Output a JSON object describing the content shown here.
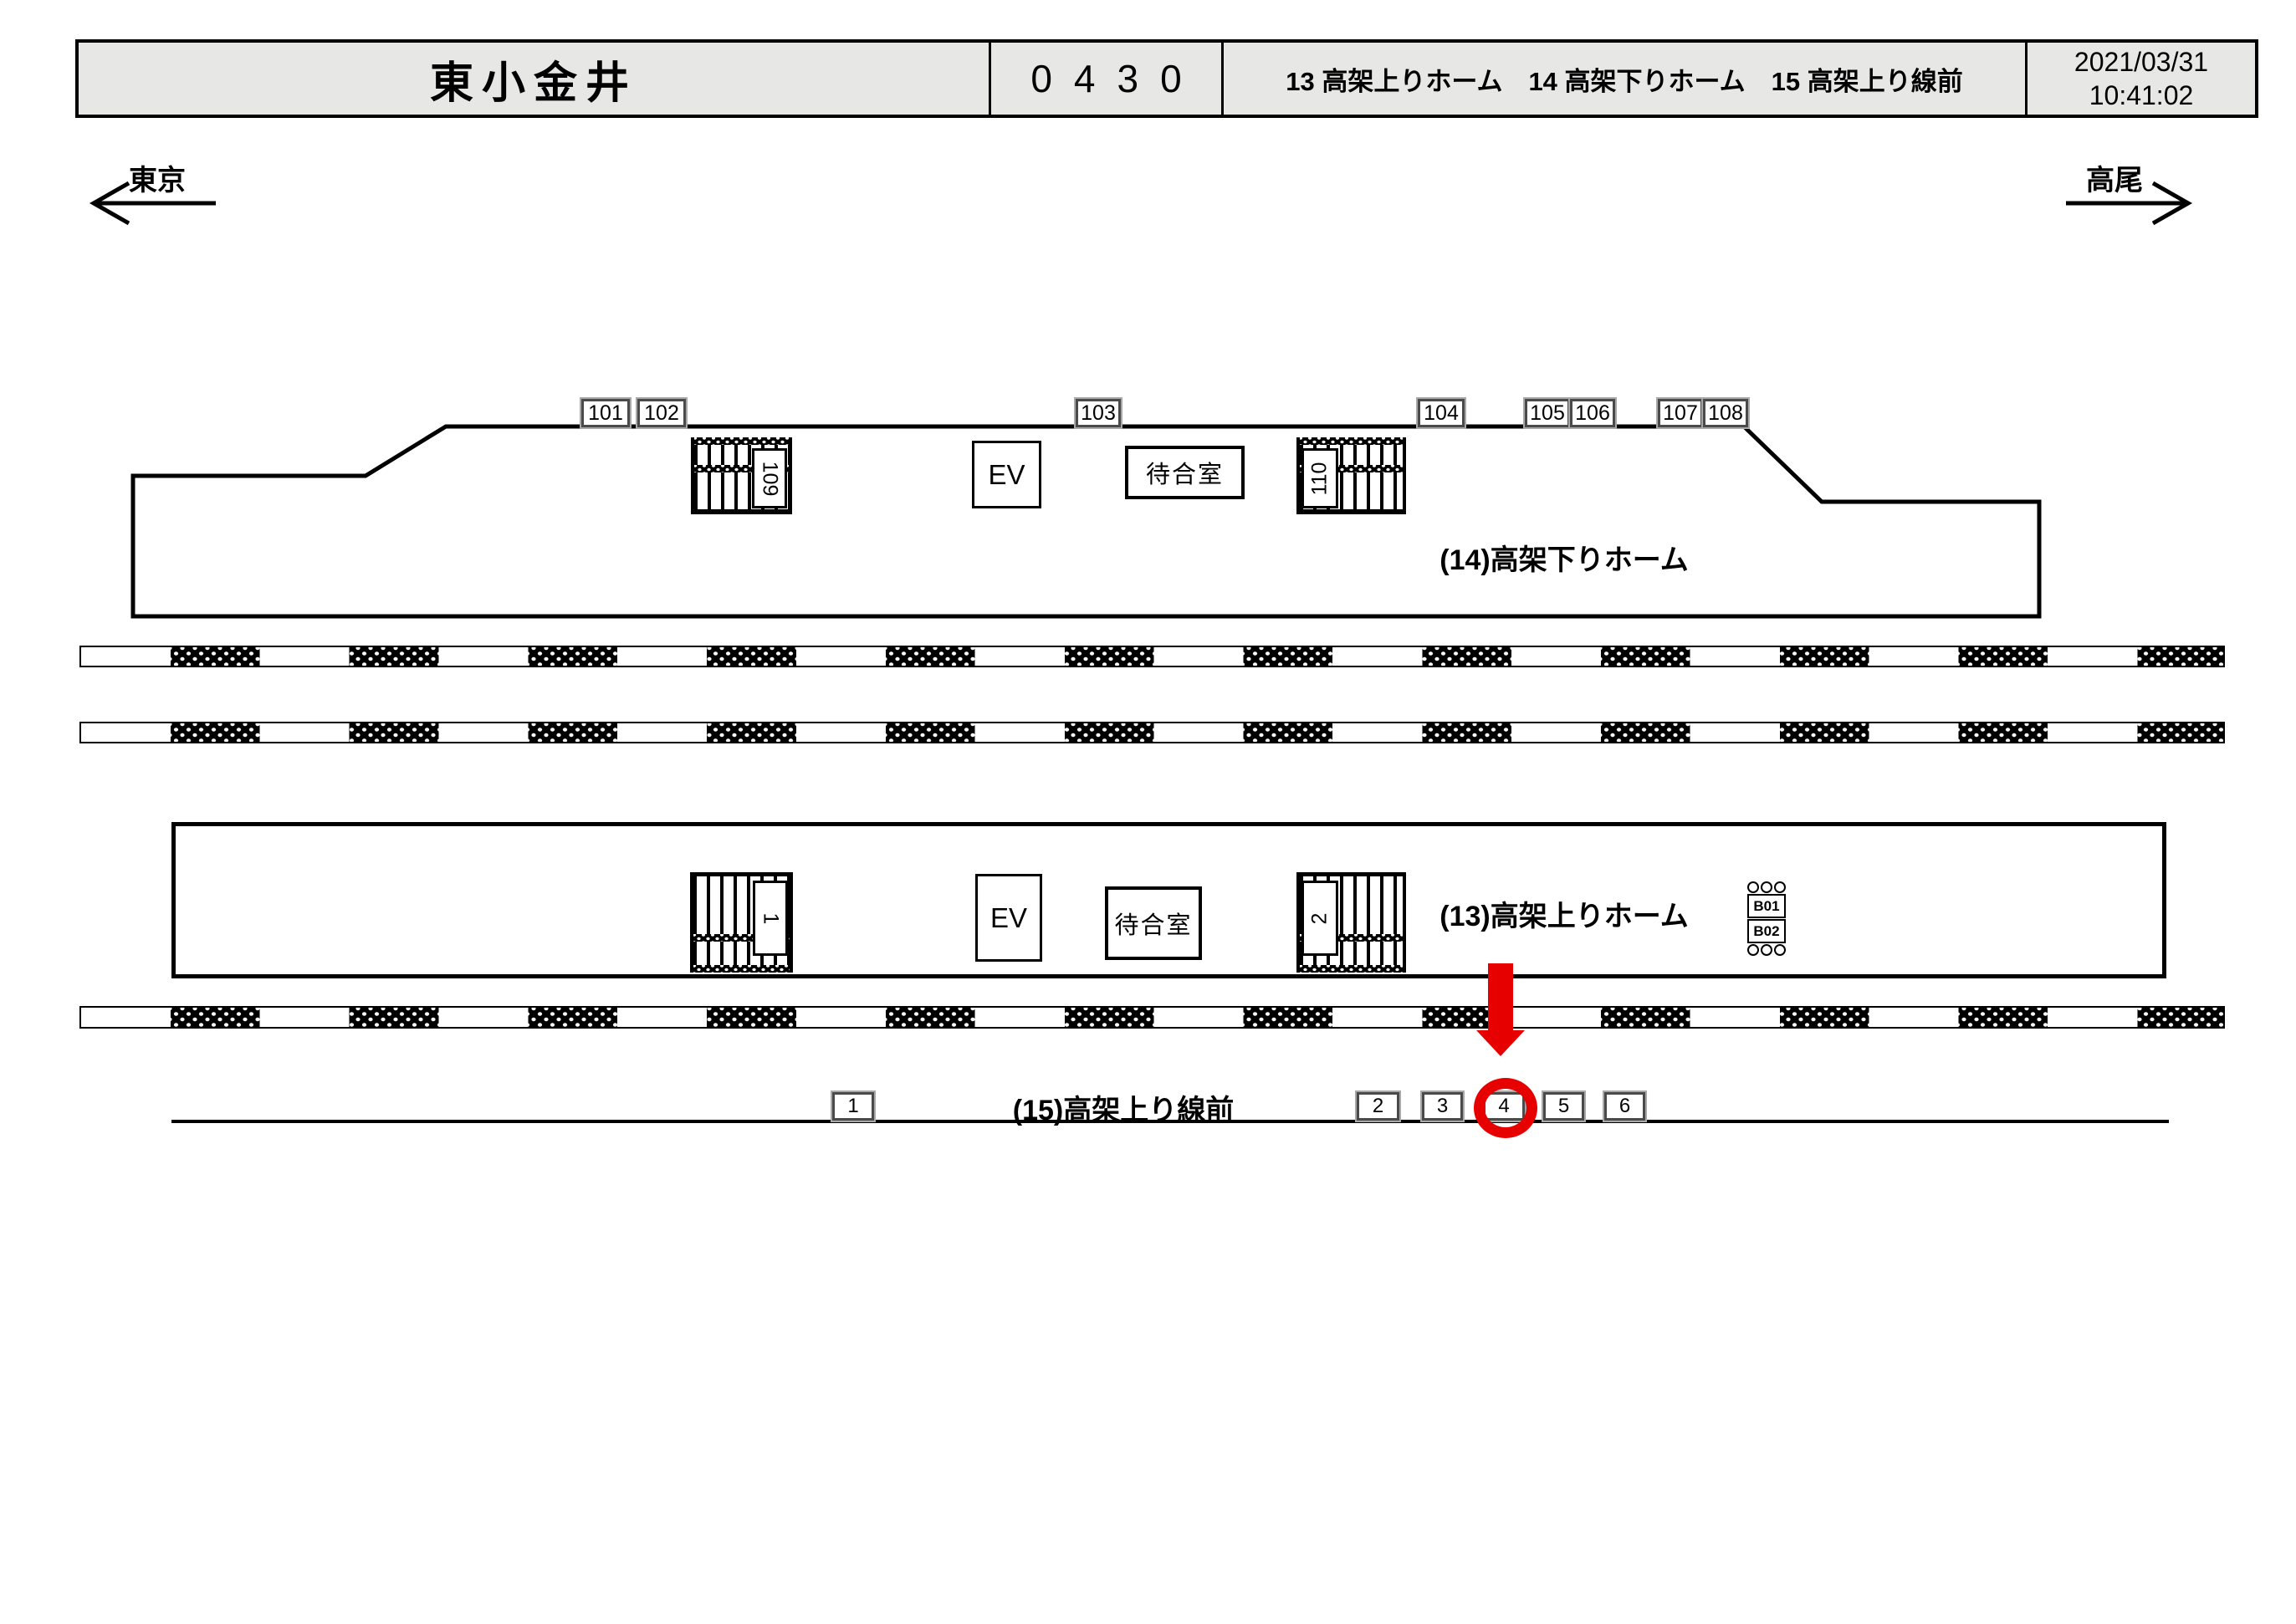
{
  "header": {
    "station_name": "東小金井",
    "station_code": "0430",
    "platform_list": "13 高架上りホーム　14 高架下りホーム　15 高架上り線前",
    "date": "2021/03/31",
    "time": "10:41:02"
  },
  "directions": {
    "left": "東京",
    "right": "高尾"
  },
  "platform14": {
    "label": "(14)高架下りホーム",
    "camera_boxes": [
      "101",
      "102",
      "103",
      "104",
      "105",
      "106",
      "107",
      "108"
    ],
    "stairs_labels": [
      "109",
      "110"
    ],
    "elevator_label": "EV",
    "waiting_room_label": "待合室"
  },
  "platform13": {
    "label": "(13)高架上りホーム",
    "stairs_labels": [
      "1",
      "2"
    ],
    "elevator_label": "EV",
    "waiting_room_label": "待合室",
    "bench_boxes": [
      "B01",
      "B02"
    ]
  },
  "line15": {
    "label": "(15)高架上り線前",
    "camera_boxes": [
      "1",
      "2",
      "3",
      "4",
      "5",
      "6"
    ],
    "highlighted_box": "4"
  },
  "colors": {
    "highlight_red": "#e60000",
    "header_bg": "#e7e7e5"
  }
}
